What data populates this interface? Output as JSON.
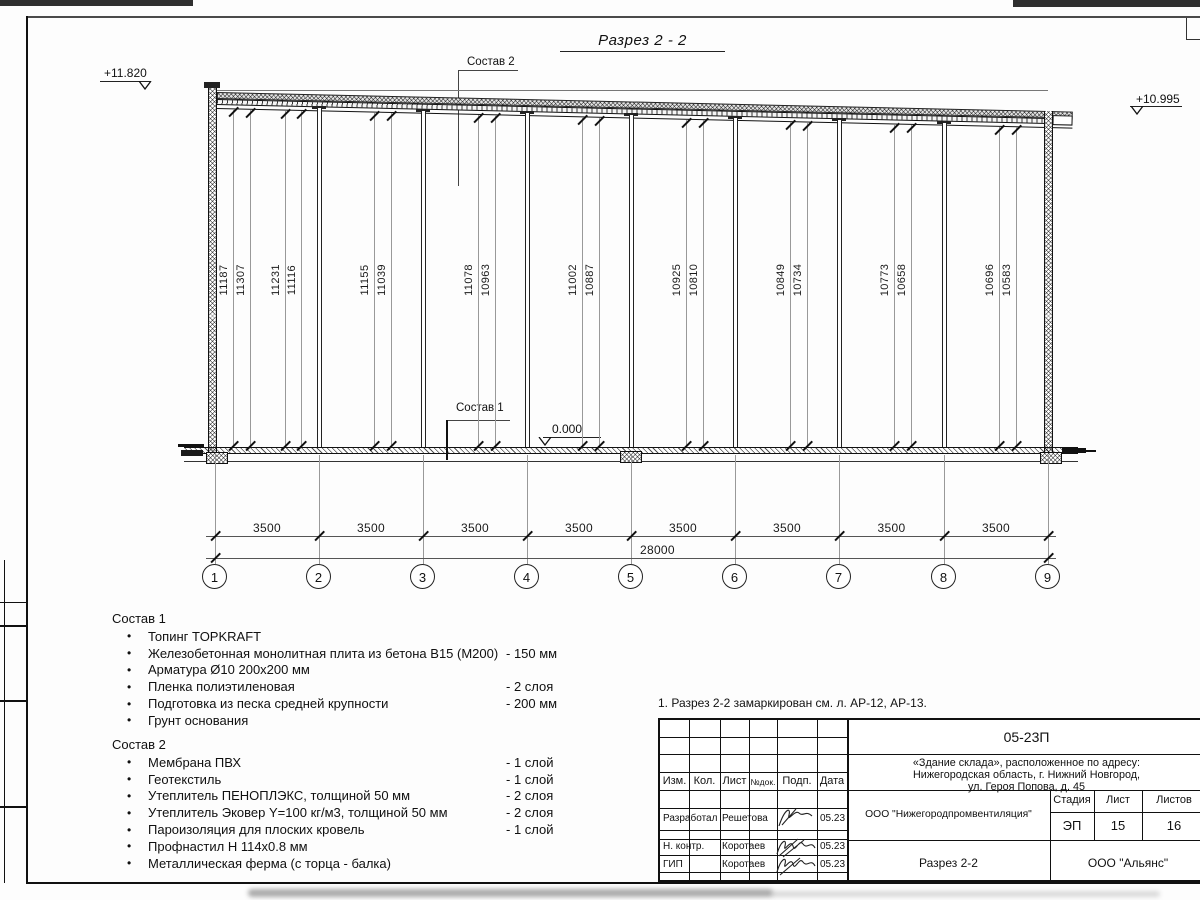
{
  "title": "Разрез 2 - 2",
  "elevations": {
    "left": "+11.820",
    "right": "+10.995",
    "zero": "0.000"
  },
  "callouts": {
    "sostav1": "Состав 1",
    "sostav2": "Состав 2"
  },
  "section": {
    "heights": [
      "11187",
      "11307",
      "11231",
      "11116",
      "11155",
      "11039",
      "11078",
      "10963",
      "11002",
      "10887",
      "10925",
      "10810",
      "10849",
      "10734",
      "10773",
      "10658",
      "10696",
      "10583"
    ]
  },
  "dimensions": {
    "bay_labels": [
      "3500",
      "3500",
      "3500",
      "3500",
      "3500",
      "3500",
      "3500",
      "3500"
    ],
    "total": "28000"
  },
  "axes": [
    "1",
    "2",
    "3",
    "4",
    "5",
    "6",
    "7",
    "8",
    "9"
  ],
  "sostav1": {
    "title": "Состав 1",
    "items": [
      {
        "name": "Топинг TOPKRAFT",
        "value": ""
      },
      {
        "name": "Железобетонная монолитная плита из бетона В15 (М200)",
        "value": "-  150 мм"
      },
      {
        "name": "Арматура Ø10 200х200 мм",
        "value": ""
      },
      {
        "name": "Пленка полиэтиленовая",
        "value": "- 2 слоя"
      },
      {
        "name": "Подготовка из песка средней крупности",
        "value": "- 200 мм"
      },
      {
        "name": "Грунт основания",
        "value": ""
      }
    ]
  },
  "sostav2": {
    "title": "Состав 2",
    "items": [
      {
        "name": "Мембрана ПВХ",
        "value": "- 1 слой"
      },
      {
        "name": "Геотекстиль",
        "value": "- 1 слой"
      },
      {
        "name": "Утеплитель ПЕНОПЛЭКС, толщиной 50 мм",
        "value": "- 2 слоя"
      },
      {
        "name": "Утеплитель Эковер Y=100 кг/м3, толщиной 50 мм",
        "value": "- 2 слоя"
      },
      {
        "name": "Пароизоляция для плоских кровель",
        "value": "- 1 слой"
      },
      {
        "name": "Профнастил Н 114х0.8 мм",
        "value": ""
      },
      {
        "name": "Металлическая ферма (с торца - балка)",
        "value": ""
      }
    ]
  },
  "note": "1. Разрез 2-2 замаркирован см. л. АР-12, АР-13.",
  "title_block": {
    "doc_number": "05-23П",
    "project_line1": "«Здание склада», расположенное по адресу:",
    "project_line2": "Нижегородская область, г. Нижний Новгород,",
    "project_line3": "ул. Героя Попова, д. 45",
    "columns": [
      "Изм.",
      "Кол.",
      "Лист",
      "№док.",
      "Подп.",
      "Дата"
    ],
    "rows": [
      {
        "role": "Разработал",
        "name": "Решетова",
        "date": "05.23"
      },
      {
        "role": "Н. контр.",
        "name": "Коротаев",
        "date": "05.23"
      },
      {
        "role": "ГИП",
        "name": "Коротаев",
        "date": "05.23"
      }
    ],
    "org": "ООО \"Нижегородпромвентиляция\"",
    "stage_label": "Стадия",
    "sheet_label": "Лист",
    "sheets_label": "Листов",
    "stage": "ЭП",
    "sheet": "15",
    "sheets": "16",
    "drawing_name": "Разрез 2-2",
    "contractor": "ООО \"Альянс\""
  },
  "colors": {
    "ink": "#111111",
    "thin": "#8a8a8a",
    "scan_bar": "#2f2f2f"
  }
}
